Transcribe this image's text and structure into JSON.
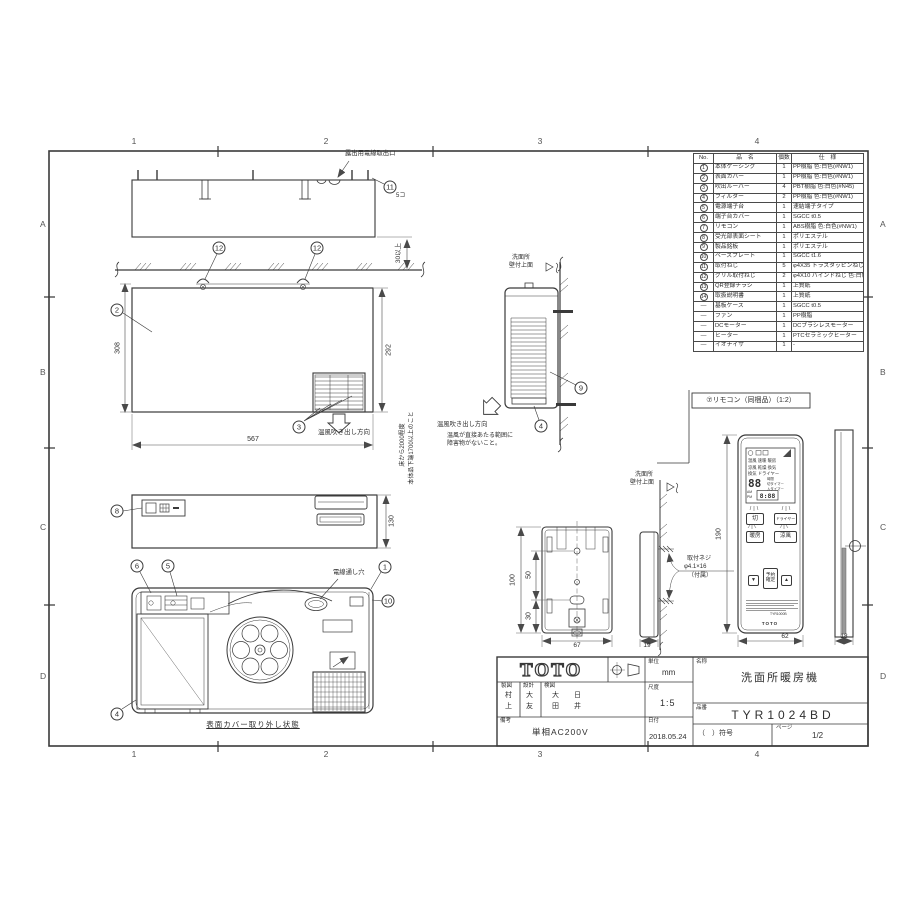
{
  "grid": {
    "cols": [
      "1",
      "2",
      "3",
      "4"
    ],
    "rows": [
      "A",
      "B",
      "C",
      "D"
    ]
  },
  "parts_table": {
    "headers": [
      "No.",
      "品　名",
      "個数",
      "仕　様"
    ],
    "rows": [
      {
        "no": "1",
        "circled": true,
        "name": "本体ケーシング",
        "qty": "1",
        "spec": "PP樹脂 色:白色(#NW1)"
      },
      {
        "no": "2",
        "circled": true,
        "name": "表面カバー",
        "qty": "1",
        "spec": "PP樹脂 色:白色(#NW1)"
      },
      {
        "no": "3",
        "circled": true,
        "name": "吹出ルーバー",
        "qty": "4",
        "spec": "PBT樹脂 色:白色(#N45)"
      },
      {
        "no": "4",
        "circled": true,
        "name": "フィルター",
        "qty": "2",
        "spec": "PP樹脂 色:白色(#NW1)"
      },
      {
        "no": "5",
        "circled": true,
        "name": "電源端子台",
        "qty": "1",
        "spec": "速結端子タイプ"
      },
      {
        "no": "6",
        "circled": true,
        "name": "端子台カバー",
        "qty": "1",
        "spec": "SGCC t0.5"
      },
      {
        "no": "7",
        "circled": true,
        "name": "リモコン",
        "qty": "1",
        "spec": "ABS樹脂 色:白色(#NW1)"
      },
      {
        "no": "8",
        "circled": true,
        "name": "受光部表面シート",
        "qty": "1",
        "spec": "ポリエステル"
      },
      {
        "no": "9",
        "circled": true,
        "name": "製品銘板",
        "qty": "1",
        "spec": "ポリエステル"
      },
      {
        "no": "10",
        "circled": true,
        "name": "ベースプレート",
        "qty": "1",
        "spec": "SGCC t1.6"
      },
      {
        "no": "11",
        "circled": true,
        "name": "取付ねじ",
        "qty": "5",
        "spec": "φ4X35 トラスタッピンねじ"
      },
      {
        "no": "12",
        "circled": true,
        "name": "グリル取付ねじ",
        "qty": "2",
        "spec": "φ4X10 バインドねじ 色:白色"
      },
      {
        "no": "13",
        "circled": true,
        "name": "QR登録チラシ",
        "qty": "1",
        "spec": "上質紙"
      },
      {
        "no": "14",
        "circled": true,
        "name": "取扱説明書",
        "qty": "1",
        "spec": "上質紙"
      },
      {
        "no": "—",
        "circled": false,
        "name": "基板ケース",
        "qty": "1",
        "spec": "SGCC t0.5"
      },
      {
        "no": "—",
        "circled": false,
        "name": "ファン",
        "qty": "1",
        "spec": "PP樹脂"
      },
      {
        "no": "—",
        "circled": false,
        "name": "DCモーター",
        "qty": "1",
        "spec": "DCブラシレスモーター"
      },
      {
        "no": "—",
        "circled": false,
        "name": "ヒーター",
        "qty": "1",
        "spec": "PTCセラミックヒーター"
      },
      {
        "no": "—",
        "circled": false,
        "name": "イオナイザ",
        "qty": "1",
        "spec": "-"
      }
    ]
  },
  "top_view": {
    "outlet_label": "露出用電線取出口",
    "b11": "11",
    "b11_qty": "5コ",
    "b12": "12",
    "gap": "30以上"
  },
  "front_view": {
    "b2": "2",
    "b3": "3",
    "dim_total": "308",
    "dim_cover": "292",
    "dim_width": "567",
    "air": "温風吹き出し方向",
    "note1": "床から2000程度",
    "note2": "本体品下端1700以上のこと"
  },
  "side_view": {
    "wall1": "洗面所",
    "wall2": "壁付上面",
    "b9": "9",
    "b4": "4",
    "air": "温風吹き出し方向",
    "note1": "温風が直接あたる範囲に",
    "note2": "障害物がないこと。"
  },
  "bottom_view": {
    "b8": "8",
    "dim": "130"
  },
  "internal_view": {
    "b6": "6",
    "b5": "5",
    "b1": "1",
    "b10": "10",
    "b4": "4",
    "hole": "電線通し穴",
    "caption": "表面カバー取り外し状態"
  },
  "holder": {
    "wall1": "洗面所",
    "wall2": "壁付上面",
    "d100": "100",
    "d50": "50",
    "d30": "30",
    "d67": "67",
    "d19": "19",
    "screw1": "取付ネジ",
    "screw2": "φ4.1×16",
    "screw3": "（付属）"
  },
  "remote": {
    "title": "⑦リモコン（同梱品）（1:2）",
    "d190": "190",
    "d62": "62",
    "d18": "18",
    "disp": {
      "m1": "温風 速暖 暖房",
      "m2": "涼風 乾燥 換気",
      "m3": "換気 ドライヤー",
      "digits": "88",
      "t1": "時間",
      "t2": "切タイマー",
      "t3": "入タイマー",
      "am": "AM",
      "pm": "PM",
      "time": "8:88"
    },
    "btn": {
      "stop": "切",
      "dryer": "ドライヤー",
      "heat": "暖房",
      "cool": "涼風",
      "down": "▼",
      "rsv1": "予約",
      "rsv2": "確定",
      "up": "▲"
    },
    "model": "TYR1000B",
    "logo": "TOTO"
  },
  "title_block": {
    "logo": "TOTO",
    "unit_l": "単位",
    "unit_v": "mm",
    "name_l": "名称",
    "name_v": "洗面所暖房機",
    "scale_l": "尺度",
    "scale_v": "1:5",
    "code_l": "品番",
    "code_v": "TYR1024BD",
    "date_l": "日付",
    "date_v": "2018.05.24",
    "note_l": "備考",
    "note_v": "単相AC200V",
    "sign_l": "（　）符号",
    "page_l": "ページ",
    "page_v": "1/2",
    "draft": "製図",
    "design": "設計",
    "check": "検図",
    "n1a": "村",
    "n1b": "上",
    "n2a": "大",
    "n2b": "友",
    "n3a": "大",
    "n3b": "田",
    "n4a": "日",
    "n4b": "井"
  }
}
